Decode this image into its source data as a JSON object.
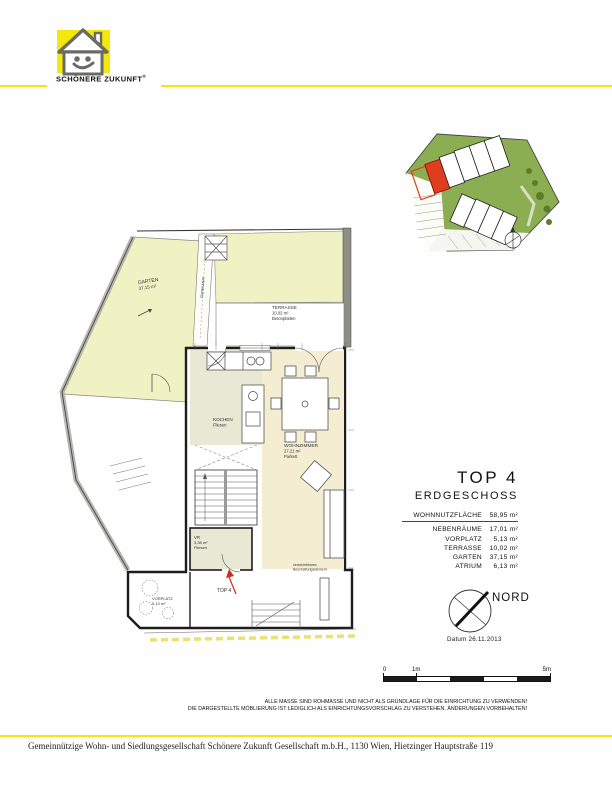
{
  "header": {
    "brand_line": "SCHÖNERE ZUKUNFT",
    "registered": "®"
  },
  "plan": {
    "garten_label": "GARTEN",
    "garten_area": "37,15 m²",
    "terrasse_label": "TERRASSE",
    "terrasse_area": "10,02 m²",
    "terrasse_finish": "Betonplatten",
    "kochen_label": "KOCHEN",
    "kochen_finish": "Fliesen",
    "wohnzimmer_label": "WOHNZIMMER",
    "wohnzimmer_area": "27,21 m²",
    "wohnzimmer_finish": "Parkett",
    "vr_label": "VR",
    "vr_area": "3,38 m²",
    "vr_finish": "Fliesen",
    "unit_label": "TOP 4",
    "vorplatz_label": "VORPLATZ",
    "vorplatz_area": "5,13 m²",
    "gartenzaun_label": "Gartenzaun",
    "beschattung_line1": "verschiebbares",
    "beschattung_line2": "Beschattungselement"
  },
  "info": {
    "unit": "TOP 4",
    "level": "ERDGESCHOSS",
    "areas": [
      {
        "label": "WOHNNUTZFLÄCHE",
        "value": "58,95 m²"
      },
      {
        "label": "NEBENRÄUME",
        "value": "17,01 m²"
      },
      {
        "label": "VORPLATZ",
        "value": "5,13 m²"
      },
      {
        "label": "TERRASSE",
        "value": "10,02 m²"
      },
      {
        "label": "GARTEN",
        "value": "37,15 m²"
      },
      {
        "label": "ATRIUM",
        "value": "6,13 m²"
      }
    ],
    "north": "NORD",
    "date": "Datum 26.11.2013"
  },
  "scalebar": {
    "t0": "0",
    "t1": "1m",
    "t5": "5m"
  },
  "disclaimer": {
    "line1": "ALLE MASSE SIND ROHMASSE UND NICHT ALS GRUNDLAGE FÜR DIE EINRICHTUNG ZU VERWENDEN!",
    "line2": "DIE DARGESTELLTE MÖBLIERUNG IST LEDIGLICH ALS EINRICHTUNGSVORSCHLAG ZU VERSTEHEN. ÄNDERUNGEN VORBEHALTEN!"
  },
  "footer": {
    "text": "Gemeinnützige Wohn- und Siedlungsgesellschaft Schönere Zukunft Gesellschaft m.b.H., 1130 Wien, Hietzinger Hauptstraße 119"
  },
  "colors": {
    "accent_yellow": "#f4e70a",
    "site_green": "#8cae52",
    "unit_red": "#e23c1e",
    "garden_pale": "#f1f2c4",
    "parquet": "#f5edd2",
    "tiles": "#e7e9d5",
    "wall_gray": "#8e8e86"
  }
}
